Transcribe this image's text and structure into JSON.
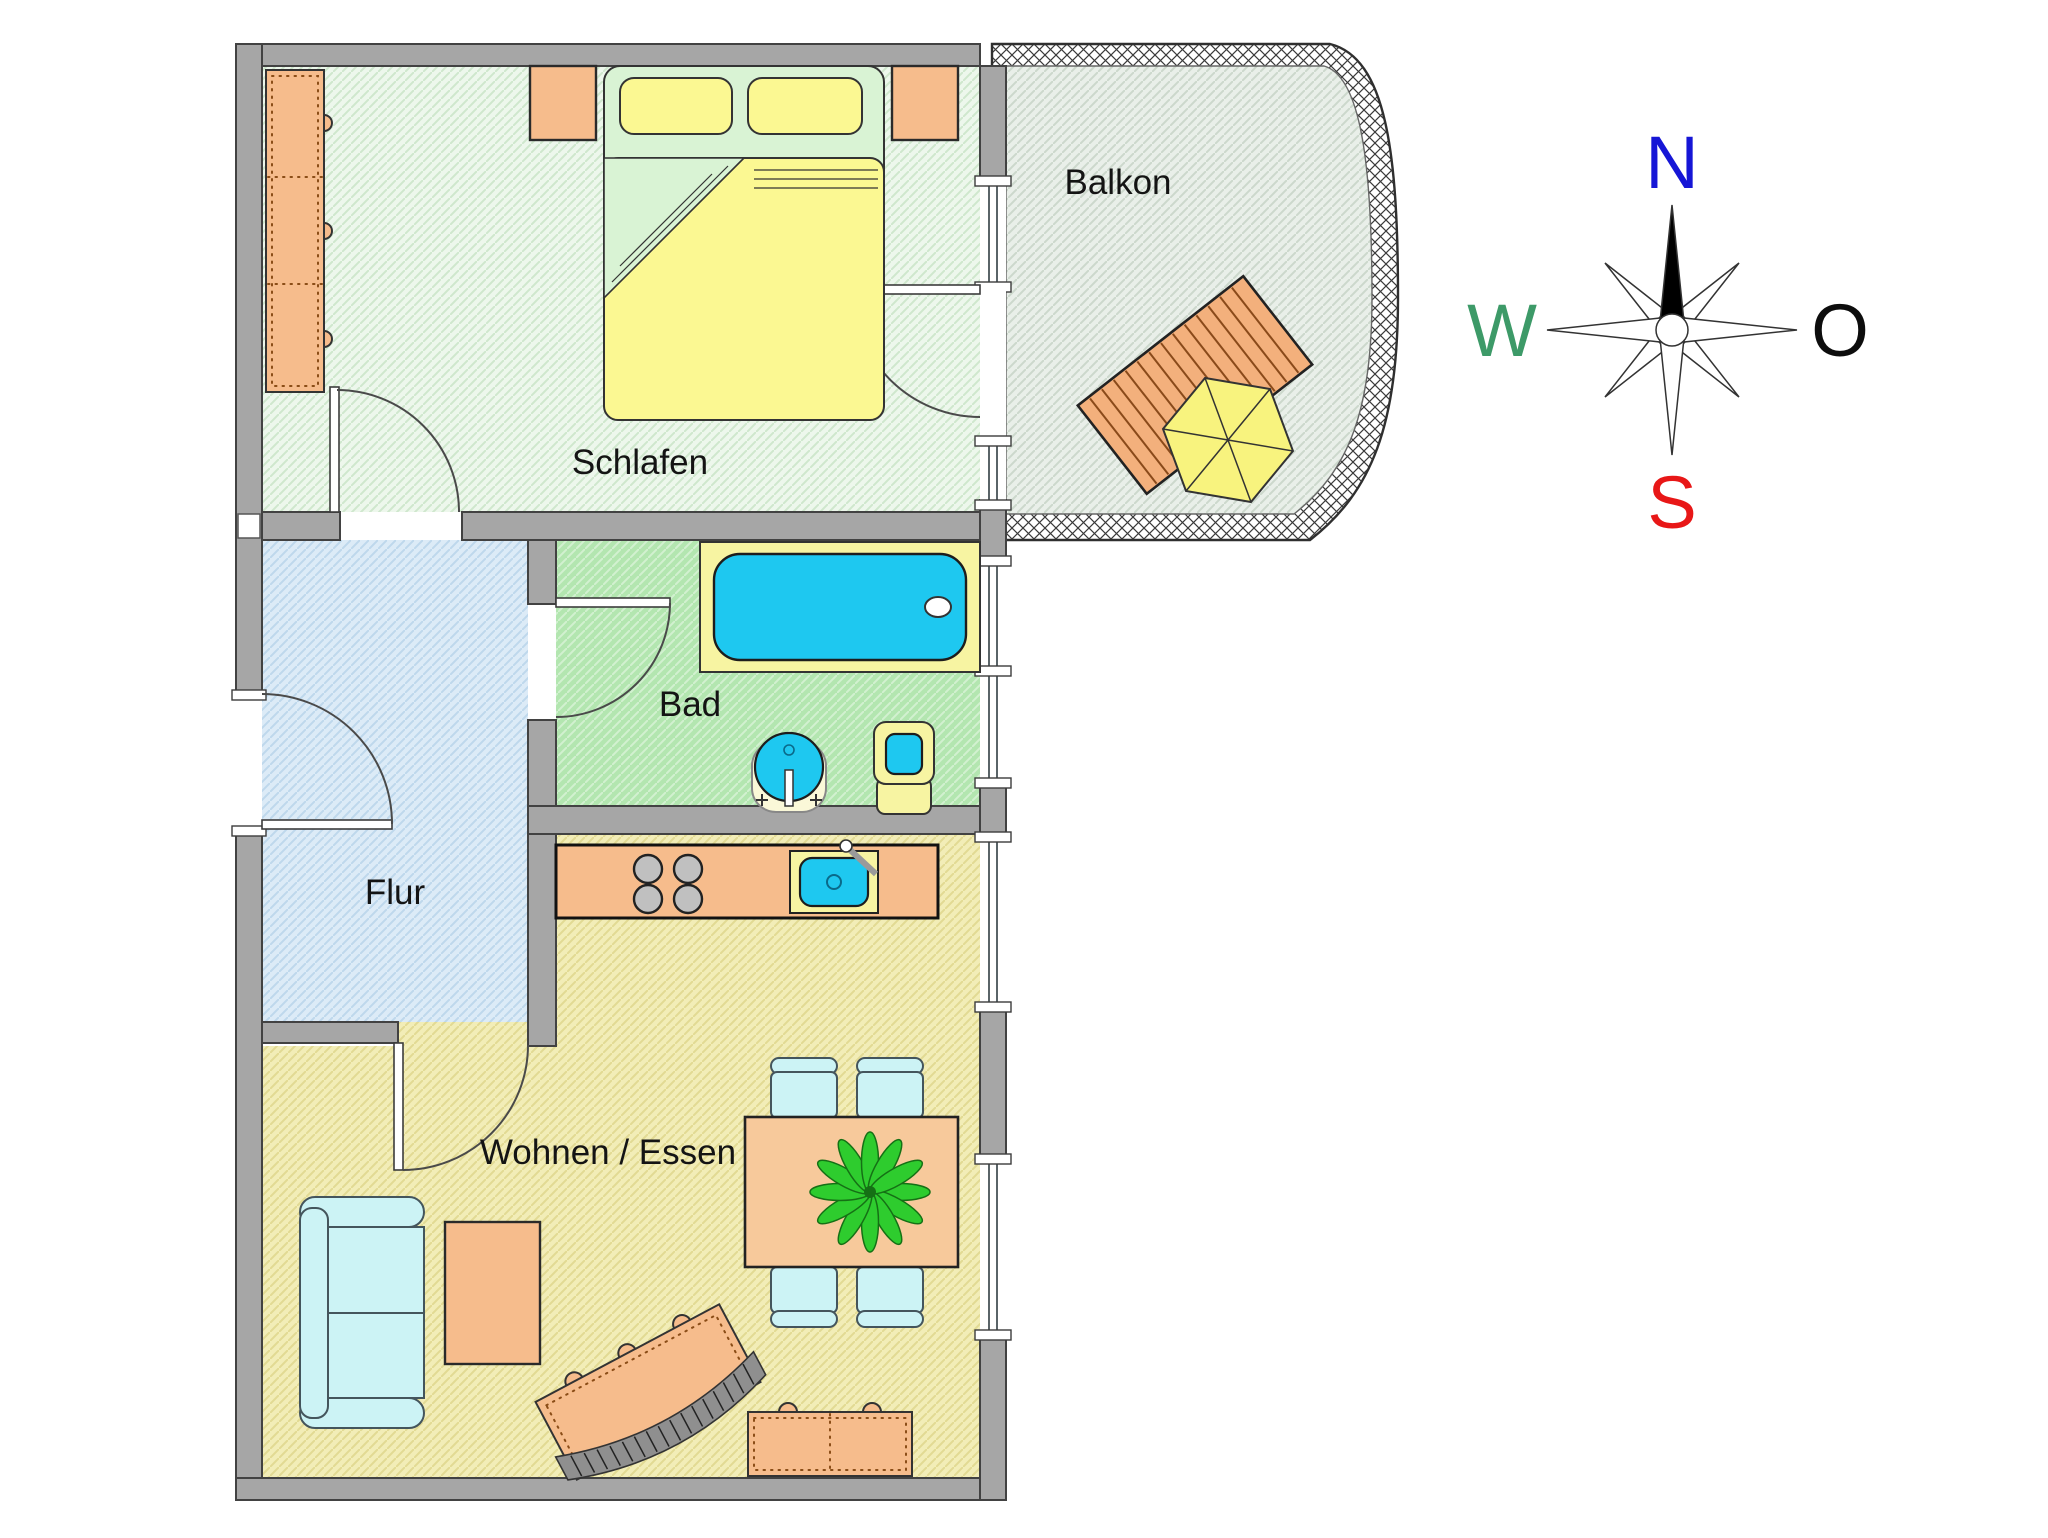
{
  "title": "Grundriss Wohnung (floor plan)",
  "rooms": {
    "schlafen": "Schlafen",
    "balkon": "Balkon",
    "bad": "Bad",
    "flur": "Flur",
    "wohnen": "Wohnen / Essen"
  },
  "compass": {
    "north": "N",
    "east": "O",
    "south": "S",
    "west": "W",
    "north_color": "#1616d6",
    "east_color": "#0d0d0d",
    "south_color": "#e81717",
    "west_color": "#3d9a68"
  },
  "palette": {
    "wall_gray": "#a6a6a6",
    "schlafen_floor": "#edf7ec",
    "balkon_floor": "#e8eee8",
    "flur_floor": "#dcebf7",
    "bad_floor": "#b3e6b0",
    "wohnen_floor": "#f2edb7",
    "furniture_orange": "#f6bc8c",
    "water_cyan": "#1ec8f0",
    "bedding_yellow": "#fbf892",
    "seating_cyan": "#ccf3f5",
    "plant_green": "#2ecc2e"
  }
}
